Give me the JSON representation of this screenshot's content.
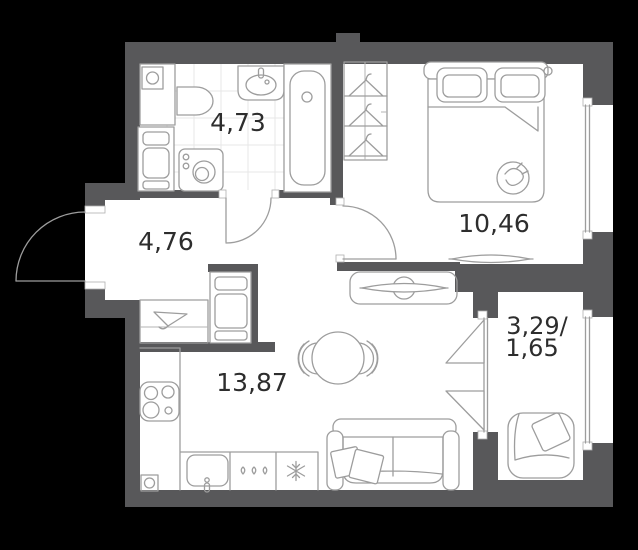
{
  "plan": {
    "rooms": {
      "bathroom": {
        "name": "bathroom",
        "area": "4,73"
      },
      "hallway": {
        "name": "hallway",
        "area": "4,76"
      },
      "bedroom": {
        "name": "bedroom",
        "area": "10,46"
      },
      "living_kitchen": {
        "name": "living-kitchen",
        "area": "13,87"
      },
      "balcony": {
        "name": "balcony",
        "area_line1": "3,29/",
        "area_line2": "1,65"
      }
    },
    "colors": {
      "wall": "#58585a",
      "furniture_line": "#9d9d9d",
      "floor": "#ffffff",
      "background": "#000000",
      "label": "#2d2d2d",
      "tile_line": "#e7e7e7"
    }
  }
}
